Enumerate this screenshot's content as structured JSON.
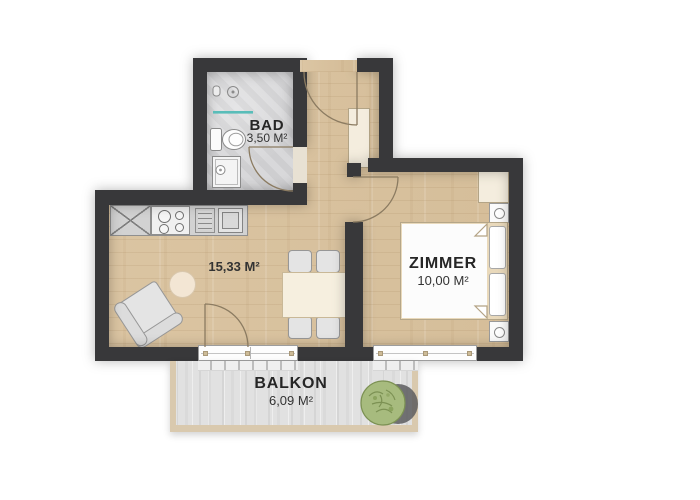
{
  "plan_title": "apartment-floor-plan",
  "rooms": {
    "bad": {
      "name": "BAD",
      "area": "3,50 M²"
    },
    "living": {
      "area": "15,33 M²"
    },
    "zimmer": {
      "name": "ZIMMER",
      "area": "10,00 M²"
    },
    "balkon": {
      "name": "BALKON",
      "area": "6,09 M²"
    }
  },
  "colors": {
    "wall": "#38383a",
    "wood_floor": "#d8c09d",
    "tile_floor": "#d6d6d8",
    "balcony_floor": "#e1e1e1",
    "balcony_frame": "#d9c9ae",
    "furniture_cream": "#f6efdf",
    "furniture_gray": "#e4e4e4",
    "shower_glass": "#59bdb9",
    "plant_green": "#a7bb7e",
    "label_text": "#262626"
  }
}
